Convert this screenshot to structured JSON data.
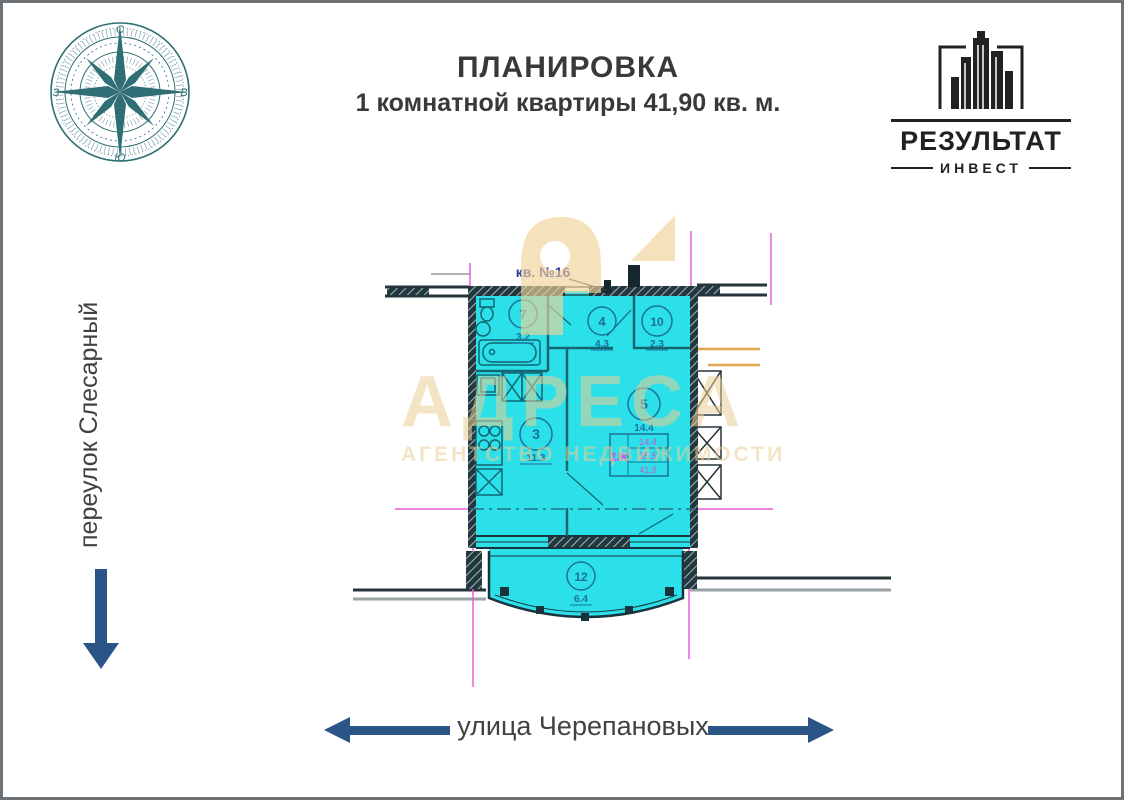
{
  "header": {
    "title_line1": "ПЛАНИРОВКА",
    "title_line2": "1 комнатной квартиры 41,90 кв. м."
  },
  "logo": {
    "name": "РЕЗУЛЬТАТ",
    "subname": "ИНВЕСТ"
  },
  "compass": {
    "north": "С",
    "east": "В",
    "south": "Ю",
    "west": "З"
  },
  "streets": {
    "left": "переулок Слесарный",
    "bottom": "улица Черепановых"
  },
  "watermark": {
    "big_text": "АДРЕСА",
    "small_text": "АГЕНТСТВО НЕДВИЖИМОСТИ"
  },
  "plan": {
    "apartment_label": "кв. №16",
    "rooms": [
      {
        "num": "7",
        "area": "3.2"
      },
      {
        "num": "4",
        "area": "4.3"
      },
      {
        "num": "10",
        "area": "2.3"
      },
      {
        "num": "3",
        "area": "11.3"
      },
      {
        "num": "5",
        "area": "14.4"
      },
      {
        "num": "12",
        "area": "6.4"
      }
    ],
    "stamp": {
      "type": "1Ж",
      "rows": [
        "14.4",
        "35.5",
        "41.9"
      ]
    }
  },
  "colors": {
    "plan_fill": "#2BE0E8",
    "axis_magenta": "#E761DD",
    "plan_blue": "#1C6FA0",
    "arrow_navy": "#2A5586",
    "context_orange": "#DFA54F",
    "watermark_tan": "#E9CF96",
    "logo_black": "#1F2123"
  }
}
